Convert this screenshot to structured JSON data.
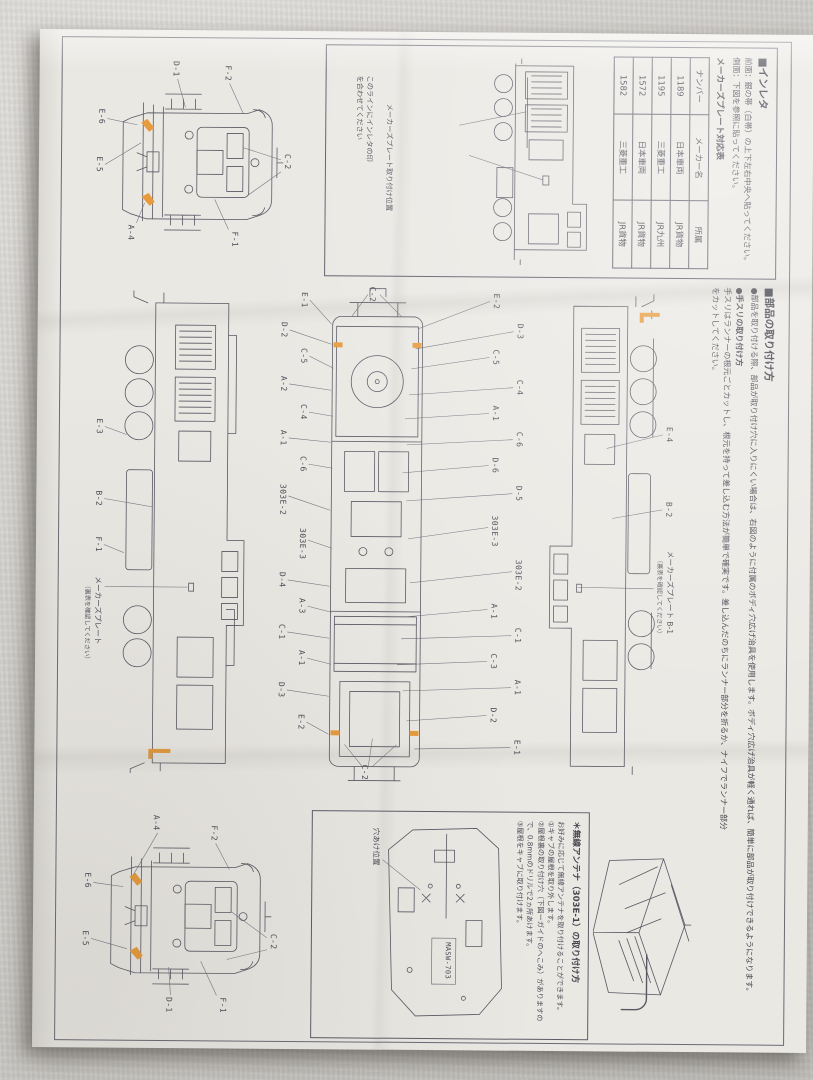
{
  "sheet": {
    "inreta": {
      "title": "■インレタ",
      "note_front": "前面：銀の帯（白帯）の上下左右中央へ貼ってください。",
      "note_side": "側面：下図を参照に貼ってください。",
      "table_title": "メーカーズプレート対応表",
      "table": {
        "headers": [
          "ナンバー",
          "メーカー名",
          "所属"
        ],
        "rows": [
          [
            "1189",
            "日本車両",
            "JR貨物"
          ],
          [
            "1195",
            "三菱重工",
            "JR九州"
          ],
          [
            "1572",
            "日本車両",
            "JR貨物"
          ],
          [
            "1582",
            "三菱重工",
            "JR貨物"
          ]
        ]
      },
      "callout_plate": "メーカーズプレート取り付け位置",
      "callout_align": "このラインにインレタの印を合わせてください"
    },
    "parts": {
      "title": "■部品の取り付け方",
      "para1": "●部品を取り付ける際、部品が取り付け穴に入りにくい場合は、右図のように付属のボディ穴広げ治具を使用します。ボディ穴広げ治具が軽く通れば、簡単に部品が取り付けできるようになります。",
      "para2_title": "●手スリの取り付け方",
      "para2": "手スリはランナーの根元ごとカットし、根元を持って差し込む方法が簡単で確実です。差し込んだのちにランナー部分を折るか、ナイフでランナー部分をカットしてください。"
    },
    "antenna": {
      "title": "＊無線アンテナ（303E-1）の取り付け方",
      "body1": "お好みに応じて無線アンテナを取り付けることができます。",
      "step1": "①キャブの屋根を取り外します。",
      "step2": "②屋根裏の取り付け穴（下図ーガイドのへこみ）がありますので、0.8mmのドリルで2ヵ所あけます。",
      "step3": "③屋根をキャブに取り付けます。",
      "hole_label": "穴あけ位置",
      "part_marking": "MASW-703"
    },
    "labels": {
      "front_a": [
        "D-1",
        "F-2",
        "C-2",
        "F-1",
        "A-4",
        "E-6",
        "E-5"
      ],
      "front_b": [
        "A-4",
        "F-2",
        "C-2",
        "F-1",
        "D-1",
        "E-6",
        "E-5"
      ],
      "side_upper": [
        "E-4",
        "B-2"
      ],
      "side_upper_plate": "メーカーズプレート B-1",
      "side_upper_note": "（裏表を確認してください）",
      "side_lower": [
        "E-3",
        "B-2",
        "F-1"
      ],
      "side_lower_plate": "メーカーズプレート",
      "side_lower_note": "（裏表を確認してください）",
      "top_above": [
        "E-2",
        "D-3",
        "C-5",
        "C-4",
        "A-1",
        "C-6",
        "D-6",
        "D-5",
        "303E-3",
        "303E-2",
        "A-1",
        "C-1",
        "C-3",
        "A-1",
        "D-2",
        "E-1"
      ],
      "top_below": [
        "E-1",
        "D-2",
        "C-5",
        "A-2",
        "C-4",
        "A-1",
        "C-6",
        "303E-2",
        "303E-3",
        "D-4",
        "A-3",
        "C-1",
        "A-1",
        "D-3",
        "E-2"
      ],
      "top_end_left": "C-2",
      "top_end_right": "C-2"
    }
  },
  "colors": {
    "highlight_orange": "#E79B3C",
    "ink": "#585864",
    "paper": "#EAE8E3",
    "fabric": "#D3D1CD"
  }
}
